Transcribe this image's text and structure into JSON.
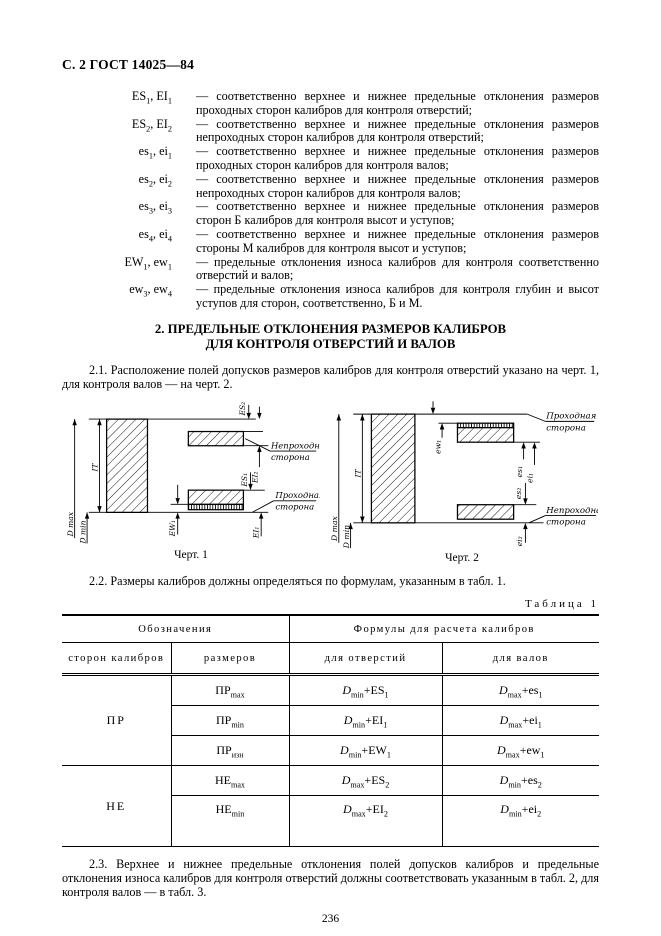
{
  "page": {
    "header": "С. 2 ГОСТ 14025—84",
    "page_number": "236"
  },
  "definitions": [
    {
      "term": "ES_{1}, EI_{1}",
      "text": "— соответственно верхнее и нижнее предельные отклонения размеров проходных сторон калибров для контроля отверстий;"
    },
    {
      "term": "ES_{2}, EI_{2}",
      "text": "— соответственно верхнее и нижнее предельные отклонения размеров непроходных сторон калибров для контроля отверстий;"
    },
    {
      "term": "es_{1}, ei_{1}",
      "text": "— соответственно верхнее и нижнее предельные отклонения размеров проходных сторон калибров для контроля валов;"
    },
    {
      "term": "es_{2}, ei_{2}",
      "text": "— соответственно верхнее и нижнее предельные отклонения размеров непроходных сторон калибров для контроля валов;"
    },
    {
      "term": "es_{3}, ei_{3}",
      "text": "— соответственно верхнее и нижнее предельные отклонения размеров сторон Б калибров для контроля высот и уступов;"
    },
    {
      "term": "es_{4}, ei_{4}",
      "text": "— соответственно верхнее и нижнее предельные отклонения размеров стороны М калибров для контроля высот и уступов;"
    },
    {
      "term": "EW_{1}, ew_{1}",
      "text": "— предельные отклонения износа калибров для контроля соответственно отверстий и валов;"
    },
    {
      "term": "ew_{3}, ew_{4}",
      "text": "— предельные отклонения износа калибров для контроля глубин и высот уступов для сторон, соответственно, Б и М."
    }
  ],
  "section": {
    "title_line1": "2. ПРЕДЕЛЬНЫЕ ОТКЛОНЕНИЯ РАЗМЕРОВ КАЛИБРОВ",
    "title_line2": "ДЛЯ КОНТРОЛЯ ОТВЕРСТИЙ И ВАЛОВ"
  },
  "paragraphs": {
    "p21": "2.1. Расположение полей допусков размеров калибров для контроля отверстий указано на черт. 1, для контроля валов — на черт. 2.",
    "p22": "2.2. Размеры калибров должны определяться по формулам, указанным в табл. 1.",
    "p23": "2.3. Верхнее и нижнее предельные отклонения полей допусков калибров и предельные отклонения износа калибров для контроля отверстий должны соответствовать указанным в табл. 2, для контроля валов — в табл. 3."
  },
  "figures": {
    "fig1": {
      "caption": "Черт. 1",
      "labels": {
        "dmax": "D max",
        "dmin": "D min",
        "it": "IT",
        "es2": "ES₂",
        "ei2": "EI₂",
        "es1": "ES₁",
        "ei1": "EI₁",
        "ew1": "EW₁",
        "nogo": [
          "Непроходная",
          "сторона"
        ],
        "go": [
          "Проходная",
          "сторона"
        ]
      }
    },
    "fig2": {
      "caption": "Черт. 2",
      "labels": {
        "dmax": "D max",
        "dmin": "D min",
        "it": "IT",
        "ew1": "ew₁",
        "es1": "es₁",
        "ei1": "ei₁",
        "es2": "es₂",
        "ei2": "ei₂",
        "go": [
          "Проходная",
          "сторона"
        ],
        "nogo": [
          "Непроходная",
          "сторона"
        ]
      }
    }
  },
  "table": {
    "label": "Таблица 1",
    "header": {
      "group1": "Обозначения",
      "group2": "Формулы для расчета калибров",
      "col1": "сторон калибров",
      "col2": "размеров",
      "col3": "для отверстий",
      "col4": "для валов"
    },
    "groups": [
      {
        "side": "ПР",
        "rows": [
          {
            "size": "ПР_{max}",
            "hole": "*D*_{min}+ES_{1}",
            "shaft": "*D*_{max}+es_{1}"
          },
          {
            "size": "ПР_{min}",
            "hole": "*D*_{min}+EI_{1}",
            "shaft": "*D*_{max}+ei_{1}"
          },
          {
            "size": "ПР_{изн}",
            "hole": "*D*_{min}+EW_{1}",
            "shaft": "*D*_{max}+ew_{1}"
          }
        ]
      },
      {
        "side": "НЕ",
        "rows": [
          {
            "size": "НЕ_{max}",
            "hole": "*D*_{max}+ES_{2}",
            "shaft": "*D*_{min}+es_{2}"
          },
          {
            "size": "НЕ_{min}",
            "hole": "*D*_{max}+EI_{2}",
            "shaft": "*D*_{min}+ei_{2}"
          }
        ]
      }
    ]
  }
}
